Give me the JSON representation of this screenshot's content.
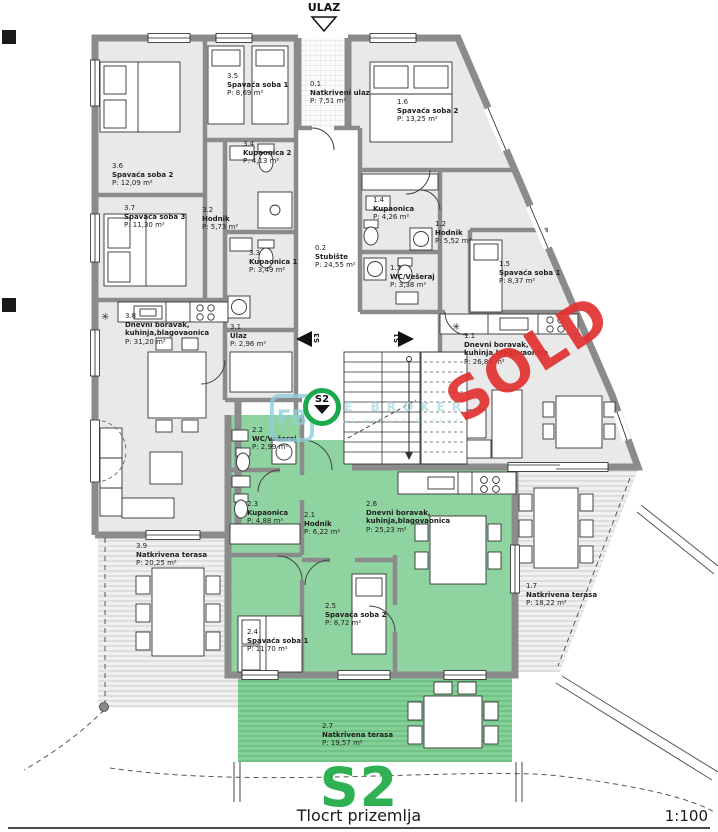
{
  "plan": {
    "entrance_label": "ULAZ",
    "sold_stamp": "SOLD",
    "unit_label_big": "S2",
    "title": "Tlocrt prizemlja",
    "scale": "1:100"
  },
  "markers": {
    "s1": "S1",
    "s2": "S2",
    "s3": "S3"
  },
  "watermark": {
    "logo": "FB",
    "line1": "RE BROKER",
    "line2": "real estate broker"
  },
  "symbols": {
    "kitchen": "✳"
  },
  "colors": {
    "apartment_green": "#8fd3a0",
    "terrace_green": "#85d098",
    "accent_green": "#2fb053",
    "sold_red": "#e23333",
    "wall_gray": "#8b8b8b",
    "room_gray": "#e9e9e9",
    "watermark_teal": "#9ad2dc"
  },
  "rooms": [
    {
      "id": "3.6",
      "name": "Spavaća soba 2",
      "area": "P: 12,09 m²"
    },
    {
      "id": "3.5",
      "name": "Spavaća soba 1",
      "area": "P: 8,69 m²"
    },
    {
      "id": "0.1",
      "name": "Natkriveni ulaz",
      "area": "P: 7,51 m²"
    },
    {
      "id": "1.6",
      "name": "Spavaća soba 2",
      "area": "P: 13,25 m²"
    },
    {
      "id": "3.4",
      "name": "Kupaonica 2",
      "area": "P: 4,13 m²"
    },
    {
      "id": "3.7",
      "name": "Spavaća soba 3",
      "area": "P: 11,30 m²"
    },
    {
      "id": "3.2",
      "name": "Hodnik",
      "area": "P: 5,73 m²"
    },
    {
      "id": "1.4",
      "name": "Kupaonica",
      "area": "P: 4,26 m²"
    },
    {
      "id": "1.2",
      "name": "Hodnik",
      "area": "P: 5,52 m²"
    },
    {
      "id": "0.2",
      "name": "Stubište",
      "area": "P: 24,55 m²"
    },
    {
      "id": "3.3",
      "name": "Kupaonica 1",
      "area": "P: 3,49 m²"
    },
    {
      "id": "1.3",
      "name": "WC/Vešeraj",
      "area": "P: 3,38 m²"
    },
    {
      "id": "1.5",
      "name": "Spavaća soba 1",
      "area": "P: 8,37 m²"
    },
    {
      "id": "3.8",
      "name": "Dnevni boravak,",
      "name2": "kuhinja,blagovaonica",
      "area": "P: 31,20 m²"
    },
    {
      "id": "3.1",
      "name": "Ulaz",
      "area": "P: 2,96 m²"
    },
    {
      "id": "1.1",
      "name": "Dnevni boravak,",
      "name2": "kuhinja,blagovaonica",
      "area": "P: 26,86 m²"
    },
    {
      "id": "2.2",
      "name": "WC/Vešeraj",
      "area": "P: 2,99 m²"
    },
    {
      "id": "2.3",
      "name": "Kupaonica",
      "area": "P: 4,88 m²"
    },
    {
      "id": "2.1",
      "name": "Hodnik",
      "area": "P: 6,22 m²"
    },
    {
      "id": "2.6",
      "name": "Dnevni boravak,",
      "name2": "kuhinja,blagovaonica",
      "area": "P: 25,23 m²"
    },
    {
      "id": "3.9",
      "name": "Natkrivena terasa",
      "area": "P: 20,25 m²"
    },
    {
      "id": "2.5",
      "name": "Spavaća soba 2",
      "area": "P: 8,72 m²"
    },
    {
      "id": "2.4",
      "name": "Spavaća soba 1",
      "area": "P: 11,70 m²"
    },
    {
      "id": "1.7",
      "name": "Natkrivena terasa",
      "area": "P: 18,22 m²"
    },
    {
      "id": "2.7",
      "name": "Natkrivena terasa",
      "area": "P: 19,57 m²"
    }
  ]
}
